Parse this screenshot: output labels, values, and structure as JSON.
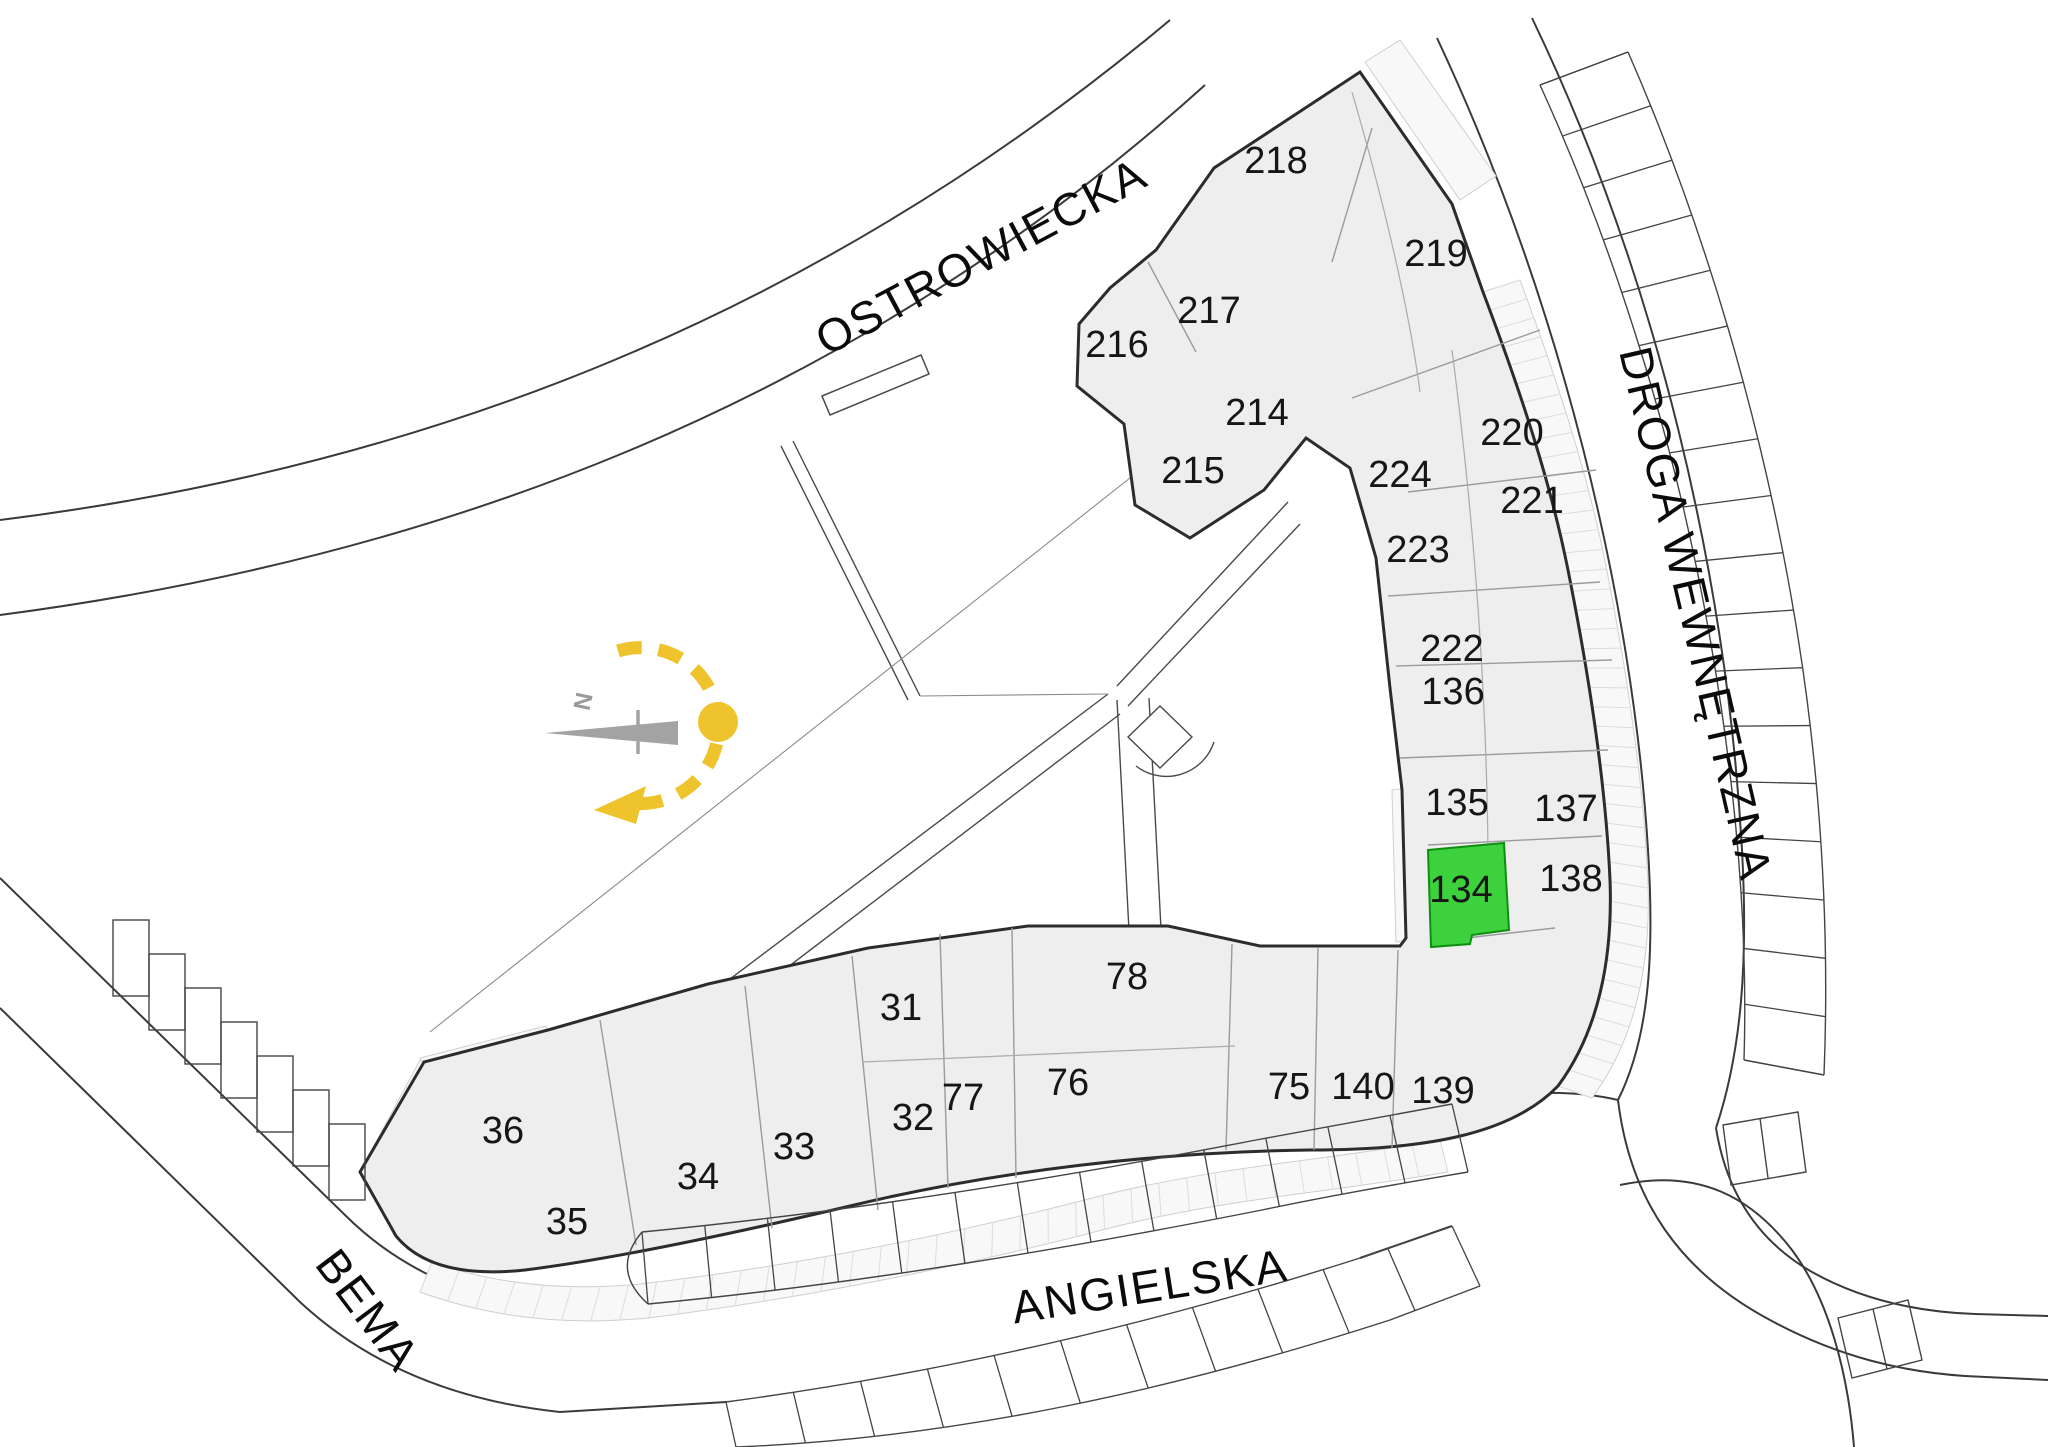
{
  "page": {
    "title": "Site plan — apartment locator",
    "type": "floor-site-plan"
  },
  "streets": {
    "top": "OSTROWIECKA",
    "right": "DROGA WEWNĘTRZNA",
    "bottom": "ANGIELSKA",
    "bottom_left": "BEMA"
  },
  "compass": {
    "north_label": "N"
  },
  "selected_unit": "134",
  "colors": {
    "highlight_fill": "#3dd23d",
    "highlight_stroke": "#0f8f0f",
    "highlight_text": "#127a12",
    "accent_yellow": "#eec32b",
    "building_fill": "#eeeeef",
    "wall": "#2c2c2c",
    "compass_gray": "#a3a3a3"
  },
  "units": [
    {
      "label": "216",
      "x": 1117,
      "y": 344,
      "highlighted": false
    },
    {
      "label": "217",
      "x": 1209,
      "y": 310,
      "highlighted": false
    },
    {
      "label": "218",
      "x": 1276,
      "y": 160,
      "highlighted": false
    },
    {
      "label": "219",
      "x": 1436,
      "y": 253,
      "highlighted": false
    },
    {
      "label": "214",
      "x": 1257,
      "y": 412,
      "highlighted": false
    },
    {
      "label": "215",
      "x": 1193,
      "y": 470,
      "highlighted": false
    },
    {
      "label": "220",
      "x": 1512,
      "y": 432,
      "highlighted": false
    },
    {
      "label": "221",
      "x": 1532,
      "y": 500,
      "highlighted": false
    },
    {
      "label": "224",
      "x": 1400,
      "y": 474,
      "highlighted": false
    },
    {
      "label": "223",
      "x": 1418,
      "y": 549,
      "highlighted": false
    },
    {
      "label": "222",
      "x": 1452,
      "y": 648,
      "highlighted": false
    },
    {
      "label": "136",
      "x": 1453,
      "y": 691,
      "highlighted": false
    },
    {
      "label": "135",
      "x": 1457,
      "y": 802,
      "highlighted": false
    },
    {
      "label": "134",
      "x": 1461,
      "y": 889,
      "highlighted": true
    },
    {
      "label": "137",
      "x": 1566,
      "y": 808,
      "highlighted": false
    },
    {
      "label": "138",
      "x": 1571,
      "y": 878,
      "highlighted": false
    },
    {
      "label": "139",
      "x": 1443,
      "y": 1090,
      "highlighted": false
    },
    {
      "label": "140",
      "x": 1363,
      "y": 1086,
      "highlighted": false
    },
    {
      "label": "75",
      "x": 1289,
      "y": 1086,
      "highlighted": false
    },
    {
      "label": "78",
      "x": 1127,
      "y": 976,
      "highlighted": false
    },
    {
      "label": "76",
      "x": 1068,
      "y": 1082,
      "highlighted": false
    },
    {
      "label": "77",
      "x": 963,
      "y": 1097,
      "highlighted": false
    },
    {
      "label": "31",
      "x": 901,
      "y": 1007,
      "highlighted": false
    },
    {
      "label": "32",
      "x": 913,
      "y": 1117,
      "highlighted": false
    },
    {
      "label": "33",
      "x": 794,
      "y": 1146,
      "highlighted": false
    },
    {
      "label": "34",
      "x": 698,
      "y": 1176,
      "highlighted": false
    },
    {
      "label": "35",
      "x": 567,
      "y": 1221,
      "highlighted": false
    },
    {
      "label": "36",
      "x": 503,
      "y": 1130,
      "highlighted": false
    }
  ]
}
